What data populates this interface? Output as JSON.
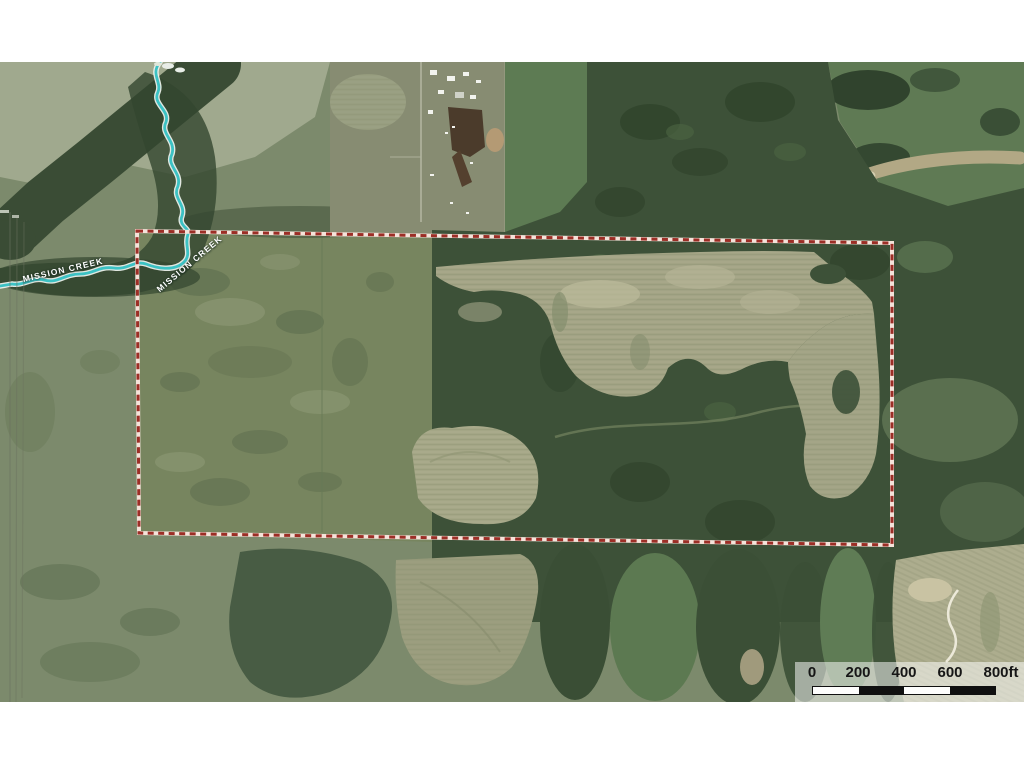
{
  "map": {
    "description": "aerial-imagery-with-parcel-boundary",
    "creek_labels": [
      {
        "text": "MISSION CREEK"
      },
      {
        "text": "MISSION CREEK"
      }
    ],
    "scalebar": {
      "labels": [
        "0",
        "200",
        "400",
        "600",
        "800ft"
      ],
      "segment_colors": [
        "white",
        "black",
        "white",
        "black"
      ]
    },
    "colors": {
      "boundary_red": "#9c2e26",
      "boundary_casing": "#f5e3da",
      "creek_teal": "#3cc2c4",
      "creek_casing": "#f0f5f0",
      "scalebar_bg": "rgba(255,255,255,0.52)"
    }
  }
}
